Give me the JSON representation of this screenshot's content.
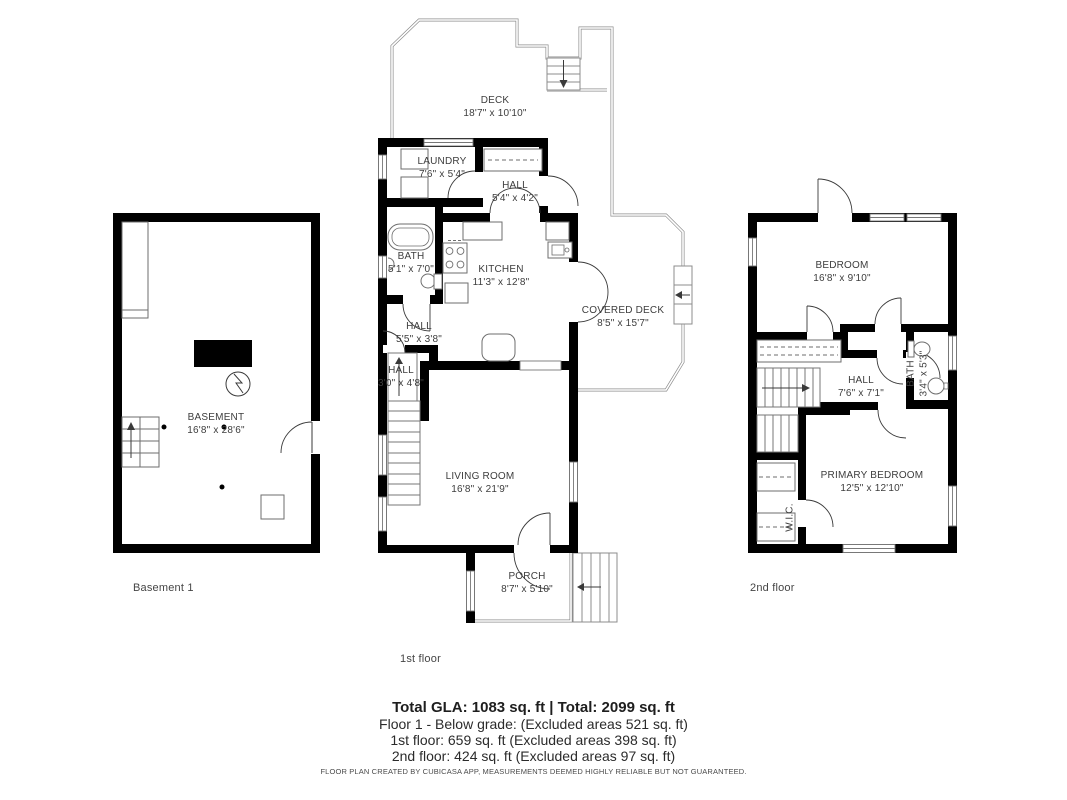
{
  "colors": {
    "wall": "#000000",
    "outline": "#8c8c8c",
    "thin": "#6e6e6e",
    "text": "#3d3d3d"
  },
  "floors": {
    "basement": {
      "label": "Basement 1",
      "rooms": [
        {
          "name": "BASEMENT",
          "dims": "16'8\" x 28'6\""
        }
      ]
    },
    "first": {
      "label": "1st floor",
      "rooms": [
        {
          "name": "DECK",
          "dims": "18'7\" x 10'10\""
        },
        {
          "name": "LAUNDRY",
          "dims": "7'6\" x 5'4\""
        },
        {
          "name": "HALL",
          "dims": "5'4\" x 4'2\""
        },
        {
          "name": "BATH",
          "dims": "5'1\" x 7'0\""
        },
        {
          "name": "KITCHEN",
          "dims": "11'3\" x 12'8\""
        },
        {
          "name": "COVERED DECK",
          "dims": "8'5\" x 15'7\""
        },
        {
          "name": "HALL",
          "dims": "5'5\" x 3'8\""
        },
        {
          "name": "HALL",
          "dims": "3'0\" x 4'8\""
        },
        {
          "name": "LIVING ROOM",
          "dims": "16'8\" x 21'9\""
        },
        {
          "name": "PORCH",
          "dims": "8'7\" x 5'10\""
        }
      ]
    },
    "second": {
      "label": "2nd floor",
      "rooms": [
        {
          "name": "BEDROOM",
          "dims": "16'8\" x 9'10\""
        },
        {
          "name": "HALL",
          "dims": "7'6\" x 7'1\""
        },
        {
          "name": "BATH",
          "dims": "3'4\" x 5'3\""
        },
        {
          "name": "PRIMARY BEDROOM",
          "dims": "12'5\" x 12'10\""
        },
        {
          "name": "W.I.C.",
          "dims": ""
        }
      ]
    }
  },
  "summary": {
    "total_line": "Total GLA: 1083 sq. ft | Total: 2099 sq. ft",
    "floor1_line": "Floor 1 - Below grade: (Excluded areas 521 sq. ft)",
    "floor2_line": "1st floor: 659 sq. ft (Excluded areas 398 sq. ft)",
    "floor3_line": "2nd floor: 424 sq. ft (Excluded areas 97 sq. ft)",
    "disclaimer": "FLOOR PLAN CREATED BY CUBICASA APP, MEASUREMENTS DEEMED HIGHLY RELIABLE BUT NOT GUARANTEED."
  }
}
